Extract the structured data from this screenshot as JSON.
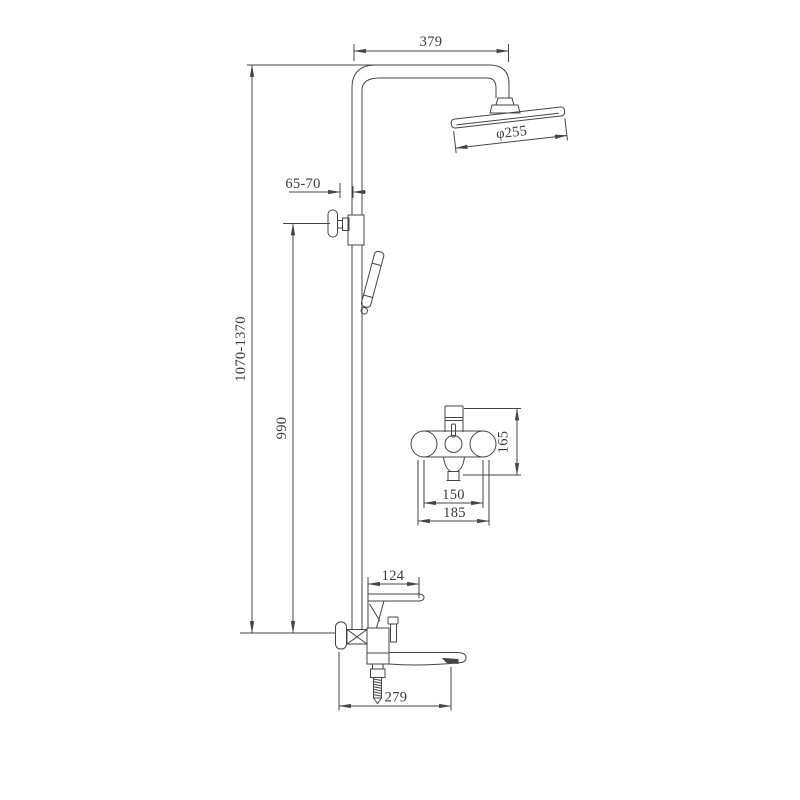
{
  "drawing": {
    "subject": "shower-column-technical-drawing",
    "units": "mm",
    "line_color": "#454545",
    "background_color": "#ffffff",
    "dimensions": {
      "arm_reach": "379",
      "head_diameter": "φ255",
      "bracket_depth": "65-70",
      "total_height": "1070-1370",
      "riser_height": "990",
      "valve_height": "165",
      "valve_hole_spacing": "150",
      "valve_width": "185",
      "handle_length": "124",
      "spout_reach": "279"
    }
  }
}
